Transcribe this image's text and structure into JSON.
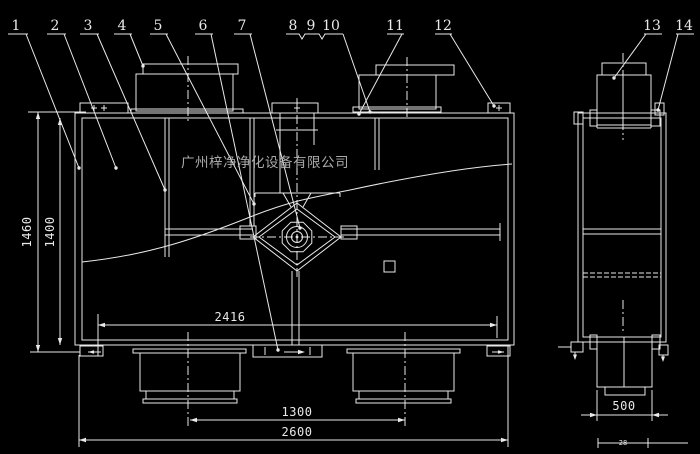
{
  "drawing": {
    "title": "air-purification-unit-cad-drawing",
    "watermark": "广州梓净净化设备有限公司",
    "callouts": [
      "1",
      "2",
      "3",
      "4",
      "5",
      "6",
      "7",
      "8",
      "9",
      "10",
      "11",
      "12",
      "13",
      "14"
    ],
    "dimensions": {
      "overall_height": "1460",
      "body_height": "1400",
      "top_flange_span": "2416",
      "duct_center_spacing": "1300",
      "overall_width": "2600",
      "side_filter_width": "500",
      "side_offset": "28"
    },
    "colors": {
      "background": "#000000",
      "line": "#e9e9e9",
      "watermark": "#bdbdbd"
    }
  }
}
